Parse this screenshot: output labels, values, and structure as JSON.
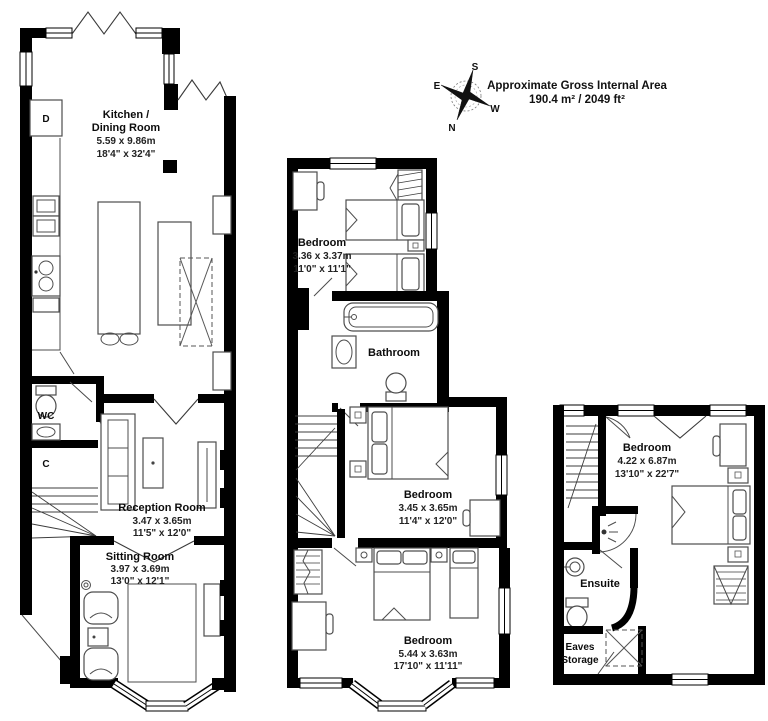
{
  "header": {
    "area_title": "Approximate Gross Internal Area",
    "area_value": "190.4 m² / 2049 ft²",
    "compass": {
      "n": "N",
      "s": "S",
      "e": "E",
      "w": "W"
    }
  },
  "ground_floor": {
    "kitchen_dining": {
      "name1": "Kitchen /",
      "name2": "Dining Room",
      "metric": "5.59 x 9.86m",
      "imperial": "18'4\" x 32'4\""
    },
    "appliance_d": "D",
    "wc": "WC",
    "cupboard_c": "C",
    "reception": {
      "name": "Reception Room",
      "metric": "3.47 x 3.65m",
      "imperial": "11'5\" x 12'0\""
    },
    "sitting": {
      "name": "Sitting Room",
      "metric": "3.97 x 3.69m",
      "imperial": "13'0\" x 12'1\""
    }
  },
  "first_floor": {
    "bedroom_front": {
      "name": "Bedroom",
      "metric": "3.36 x 3.37m",
      "imperial": "11'0\" x 11'1\""
    },
    "bathroom": {
      "name": "Bathroom"
    },
    "bedroom_middle": {
      "name": "Bedroom",
      "metric": "3.45 x 3.65m",
      "imperial": "11'4\" x 12'0\""
    },
    "bedroom_rear": {
      "name": "Bedroom",
      "metric": "5.44 x 3.63m",
      "imperial": "17'10\" x 11'11\""
    }
  },
  "second_floor": {
    "bedroom": {
      "name": "Bedroom",
      "metric": "4.22 x 6.87m",
      "imperial": "13'10\" x 22'7\""
    },
    "ensuite": {
      "name": "Ensuite"
    },
    "eaves": {
      "name1": "Eaves",
      "name2": "Storage"
    }
  },
  "colors": {
    "walls": "#000000",
    "furniture": "#4d4d4d",
    "background": "#ffffff"
  }
}
